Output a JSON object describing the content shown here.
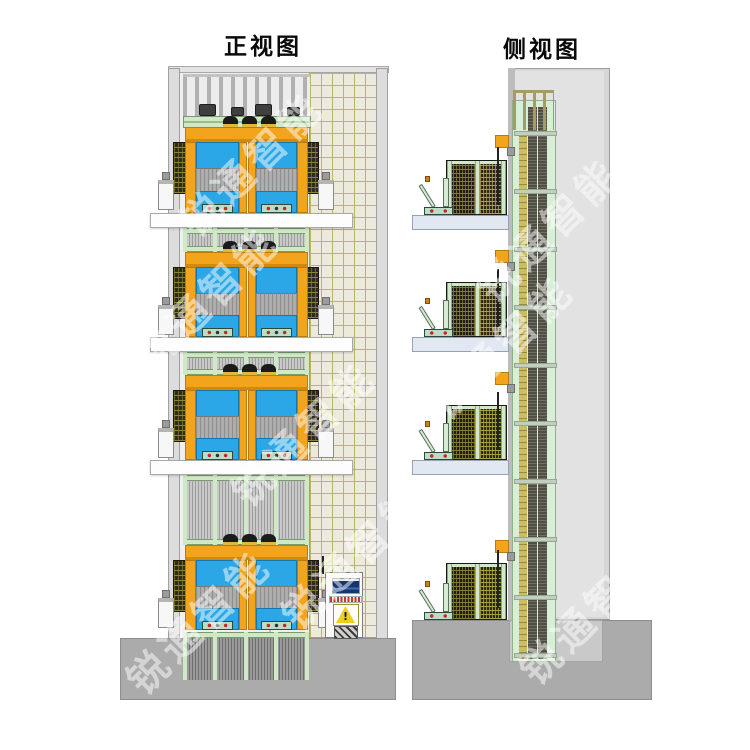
{
  "front_view": {
    "label": "正视图",
    "level_count": 4,
    "slab_count": 3,
    "hooks_per_level": 3,
    "bays_per_level": 2,
    "cabinet": {
      "warning_glyph": "!",
      "icons": [
        "display-screen-icon",
        "indicator-lights-icon",
        "warning-triangle-icon",
        "electric-hazard-icon"
      ]
    }
  },
  "side_view": {
    "label": "侧视图",
    "level_count": 4,
    "wall_tie_count": 4,
    "mast_rung_count": 10
  },
  "watermark": {
    "text": "锐通智能",
    "color": "#ffffff",
    "opacity": 0.5,
    "rotation_deg": -45,
    "instance_count": 8
  },
  "palette": {
    "frame_orange": "#f2a41c",
    "panel_blue": "#2ba7e8",
    "platform_green": "#cfe8c5",
    "mast_green": "#d9eed7",
    "safety_mesh_dark": "#2e2c1c",
    "grid_olive": "#b9b763",
    "slab_front": "#fdfdfd",
    "slab_side": "#e2e8f2",
    "concrete_base": "#ababab",
    "building_wall": "#d6d6d6",
    "warning_yellow": "#f0cf1a"
  }
}
